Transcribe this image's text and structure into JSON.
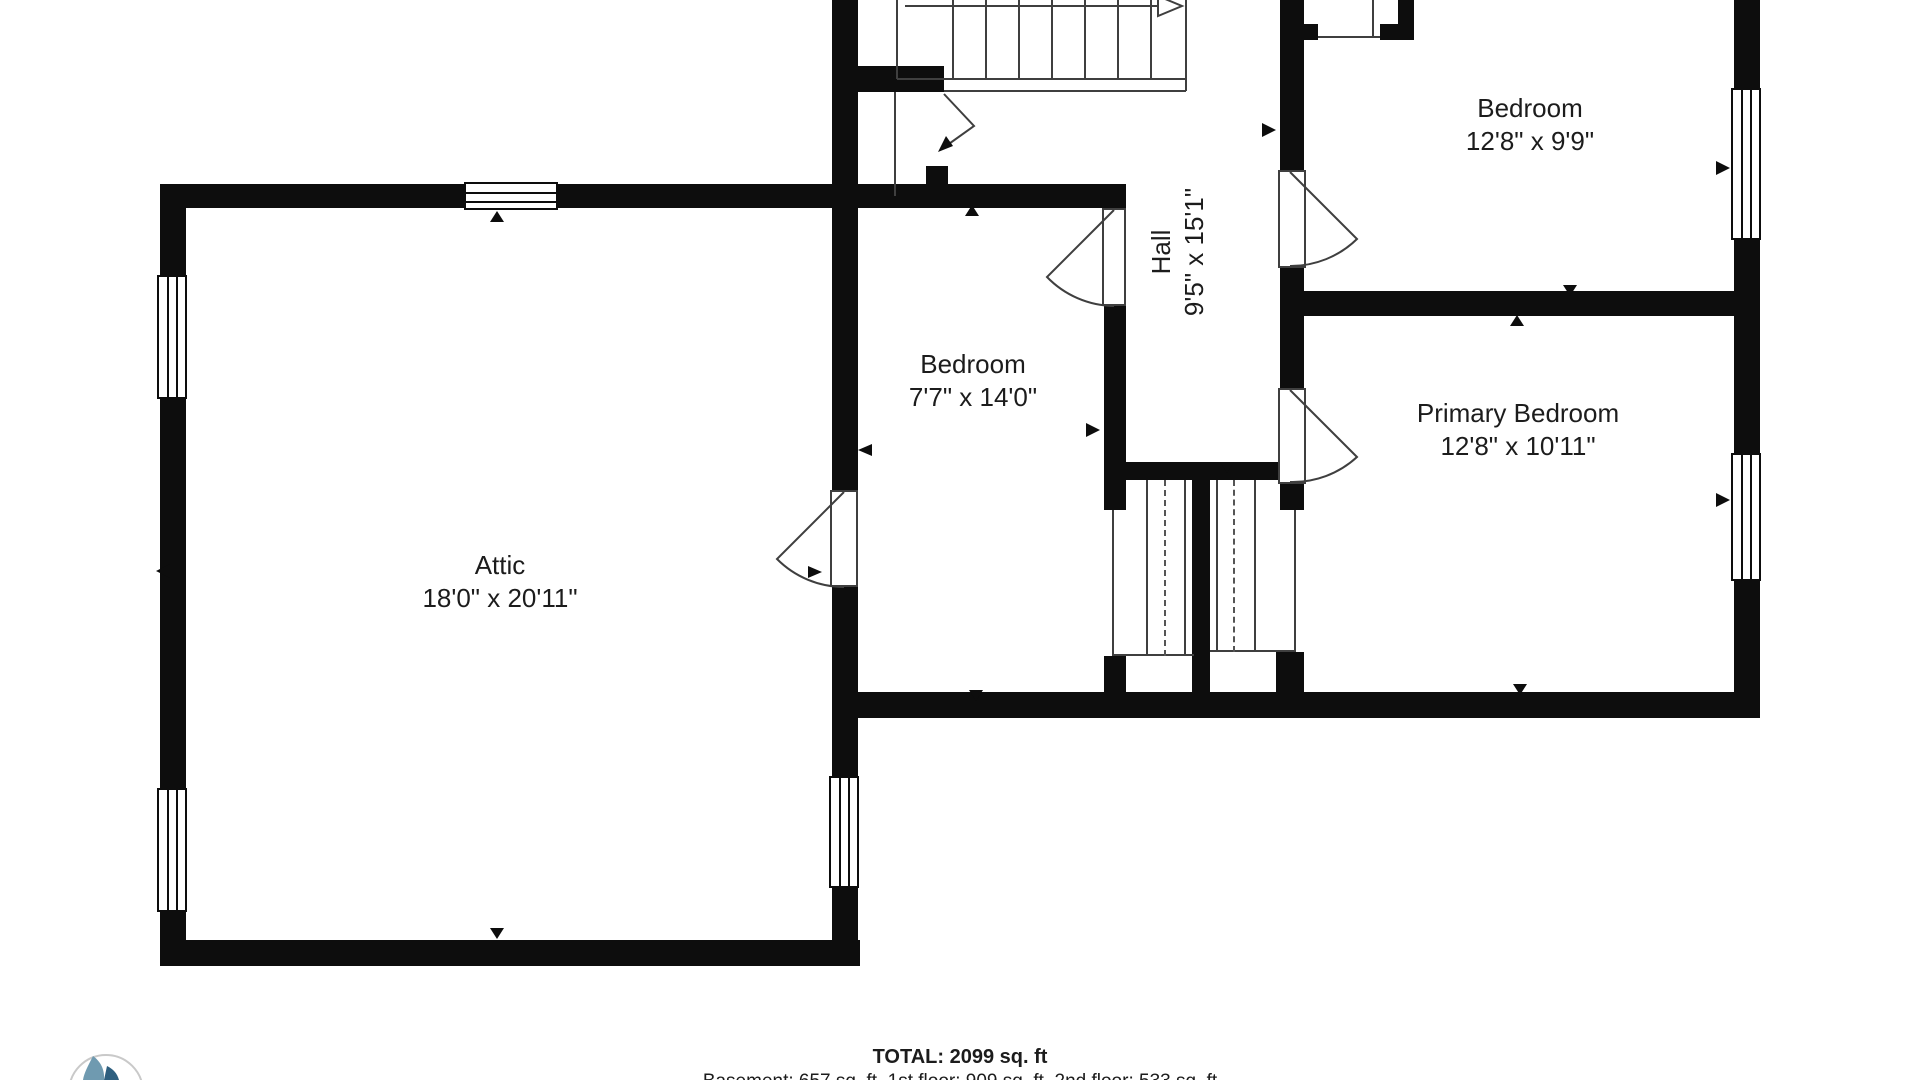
{
  "rooms": [
    {
      "name": "Attic",
      "dims": "18'0\" x 20'11\""
    },
    {
      "name": "Bedroom",
      "dims": "7'7\" x 14'0\""
    },
    {
      "name": "Hall",
      "dims": "9'5\" x 15'1\""
    },
    {
      "name": "Bedroom",
      "dims": "12'8\" x 9'9\""
    },
    {
      "name": "Primary Bedroom",
      "dims": "12'8\" x 10'11\""
    }
  ],
  "footer": {
    "total": "TOTAL: 2099 sq. ft",
    "breakdown": "Basement: 657 sq. ft, 1st floor: 909 sq. ft, 2nd floor: 533 sq. ft"
  },
  "icons": {
    "logo": "floorplanner-logo",
    "stairs_arrow": "stairs-up-direction-arrow",
    "markers": "wall-midpoint-markers"
  },
  "colors": {
    "wall": "#0d0d0d",
    "line": "#3f3f3f",
    "text": "#1c1c1c",
    "bg": "#ffffff",
    "logo-light": "#6f9ab0",
    "logo-dark": "#2e5f7f",
    "logo-ring": "#c9c9c9"
  }
}
